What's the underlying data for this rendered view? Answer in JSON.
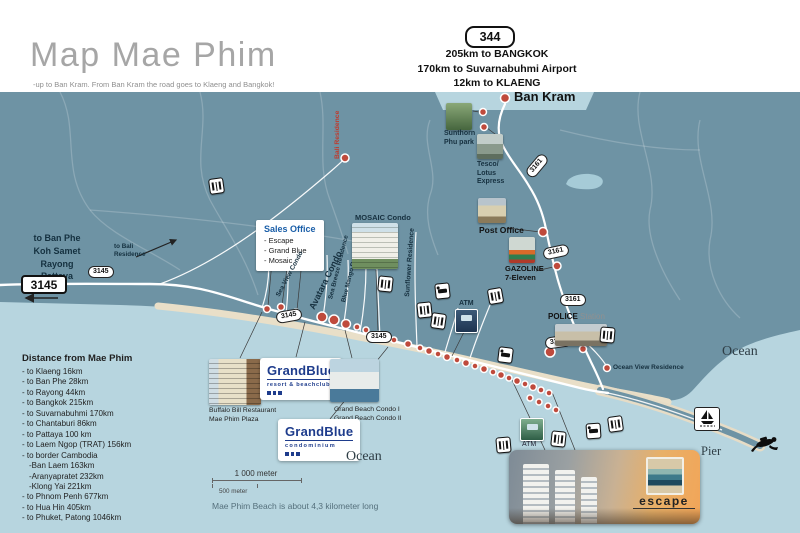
{
  "header": {
    "title": "Map Mae Phim",
    "subtitle": "-up to Ban Kram. From Ban Kram the road goes to Klaeng and Bangkok!",
    "route_badge": "344",
    "dist1": "205km to BANGKOK",
    "dist2": "170km to Suvarnabuhmi Airport",
    "dist3": "12km to KLAENG",
    "town": "Ban Kram"
  },
  "west": {
    "dest1": "to Ban Phe",
    "dest2": "Koh Samet",
    "dest3": "Rayong",
    "dest4": "Pattaya",
    "badge": "3145",
    "to_bali": "to Bali Residence"
  },
  "sales_office": {
    "title": "Sales Office",
    "item1": "- Escape",
    "item2": "- Grand Blue",
    "item3": "- Mosaic"
  },
  "places": {
    "sea_view": "Sea View Condo",
    "avatara": "Avatara Condo",
    "sea_breeze": "Sea Breeze Residence",
    "blue_mango": "Blue Mango Residence",
    "sunflower": "Sunflower Residence",
    "bali": "Bali Residence",
    "mosaic": "MOSAIC Condo",
    "sunthorn1": "Sunthorn",
    "sunthorn2": "Phu park",
    "tesco1": "Tesco/",
    "tesco2": "Lotus",
    "tesco3": "Express",
    "post_office": "Post Office",
    "gazoline1": "GAZOLINE",
    "gazoline2": "7-Eleven",
    "police": "POLICE",
    "police_sub": "Station",
    "atm": "ATM",
    "ocean_view": "Ocean View Residence",
    "ocean": "Ocean",
    "pier": "Pier"
  },
  "badges": {
    "r3145": "3145",
    "r3161": "3161"
  },
  "brands": {
    "gb_name": "GrandBlue",
    "gb_resort_sub": "resort & beachclub",
    "gb_condo_sub": "condominium",
    "escape": "escape",
    "buffalo1": "Buffalo Bill Restaurant",
    "buffalo2": "Mae Phim Plaza",
    "grand_beach1": "Grand Beach Condo I",
    "grand_beach2": "Grand Beach Condo II"
  },
  "distance_panel": {
    "title": "Distance from Mae Phim",
    "items": [
      "- to Klaeng 16km",
      "- to Ban Phe 28km",
      "- to Rayong 44km",
      "- to Bangkok 215km",
      "- to Suvarnabuhmi 170km",
      "- to Chantaburi 86km",
      "- to Pattaya 100 km",
      "- to Laem Ngop (TRAT) 156km",
      "- to border Cambodia",
      "-Ban Laem 163km",
      "-Aranyapratet 232km",
      "-Klong Yai 221km",
      "- to Phnom Penh 677km",
      "- to Hua Hin 405km",
      "- to Phuket, Patong 1046km"
    ]
  },
  "scale": {
    "long_label": "1 000 meter",
    "short_label": "500 meter"
  },
  "notes": {
    "beach": "Mae Phim Beach is about 4,3 kilometer long"
  },
  "colors": {
    "land": "#6E93A4",
    "ocean": "#B7D5DF",
    "beach": "#E9DFC8",
    "dot": "#BF4A3C",
    "brand_blue": "#1E3C8C",
    "label_blue": "#1A5EA8",
    "red_label": "#C0392B"
  }
}
